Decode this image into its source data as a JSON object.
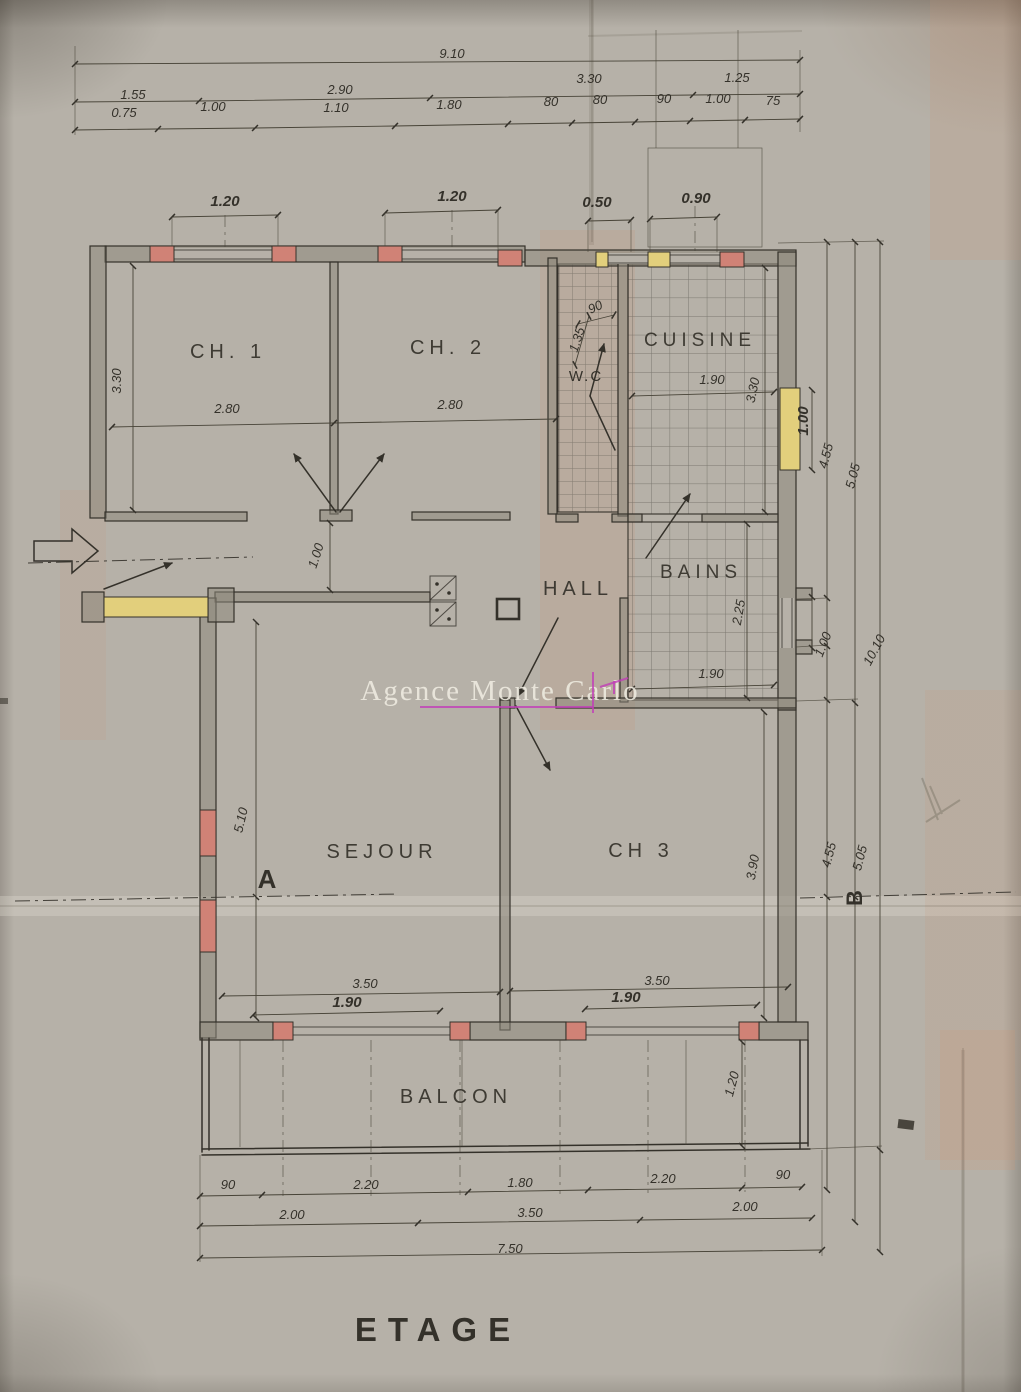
{
  "colors": {
    "paper": "#b6b1a8",
    "ink": "#34312a",
    "dimink": "#474337",
    "wall": "#8e897c",
    "red": "#d08276",
    "yellow": "#e2cf7c",
    "magenta": "#c23eb8",
    "wmtext": "#efece1"
  },
  "title": "ETAGE",
  "watermark": "Agence Monte Carlo",
  "rooms": {
    "ch1": "CH. 1",
    "ch2": "CH. 2",
    "cuisine": "CUISINE",
    "wc": "W.C",
    "hall": "HALL",
    "bains": "BAINS",
    "sejour": "SEJOUR",
    "ch3": "CH 3",
    "balcon": "BALCON"
  },
  "sections": {
    "a": "A",
    "b": "B"
  },
  "dims": {
    "top_total": "9.10",
    "top_r2_1": "1.55",
    "top_r2_2": "2.90",
    "top_r2_3": "3.30",
    "top_r2_4": "1.25",
    "top_r3_1": "0.75",
    "top_r3_2": "1.00",
    "top_r3_3": "1.10",
    "top_r3_4": "1.80",
    "top_r3_5": "80",
    "top_r3_6": "80",
    "top_r3_7": "90",
    "top_r3_8": "1.00",
    "top_r3_9": "75",
    "win_ch1": "1.20",
    "win_ch2": "1.20",
    "win_k1": "0.50",
    "win_k2": "0.90",
    "ch1_h": "3.30",
    "ch1_w": "2.80",
    "ch2_w": "2.80",
    "wc_w": "90",
    "wc_h": "1.35",
    "cuisine_w": "1.90",
    "cuisine_h": "3.30",
    "win_east": "1.00",
    "right_455a": "4.55",
    "right_505a": "5.05",
    "bains_h": "2.25",
    "bains_w": "1.90",
    "east_door": "1.00",
    "right_1010": "10.10",
    "hall_dim": "1.00",
    "sejour_h": "5.10",
    "ch3_h": "3.90",
    "right_455b": "4.55",
    "right_505b": "5.05",
    "south_l_350": "3.50",
    "south_l_190": "1.90",
    "south_r_350": "3.50",
    "south_r_190": "1.90",
    "balcon_d": "1.20",
    "bot_r1_1": "90",
    "bot_r1_2": "2.20",
    "bot_r1_3": "1.80",
    "bot_r1_4": "2.20",
    "bot_r1_5": "90",
    "bot_r2_1": "2.00",
    "bot_r2_2": "3.50",
    "bot_r2_3": "2.00",
    "bot_total": "7.50"
  }
}
